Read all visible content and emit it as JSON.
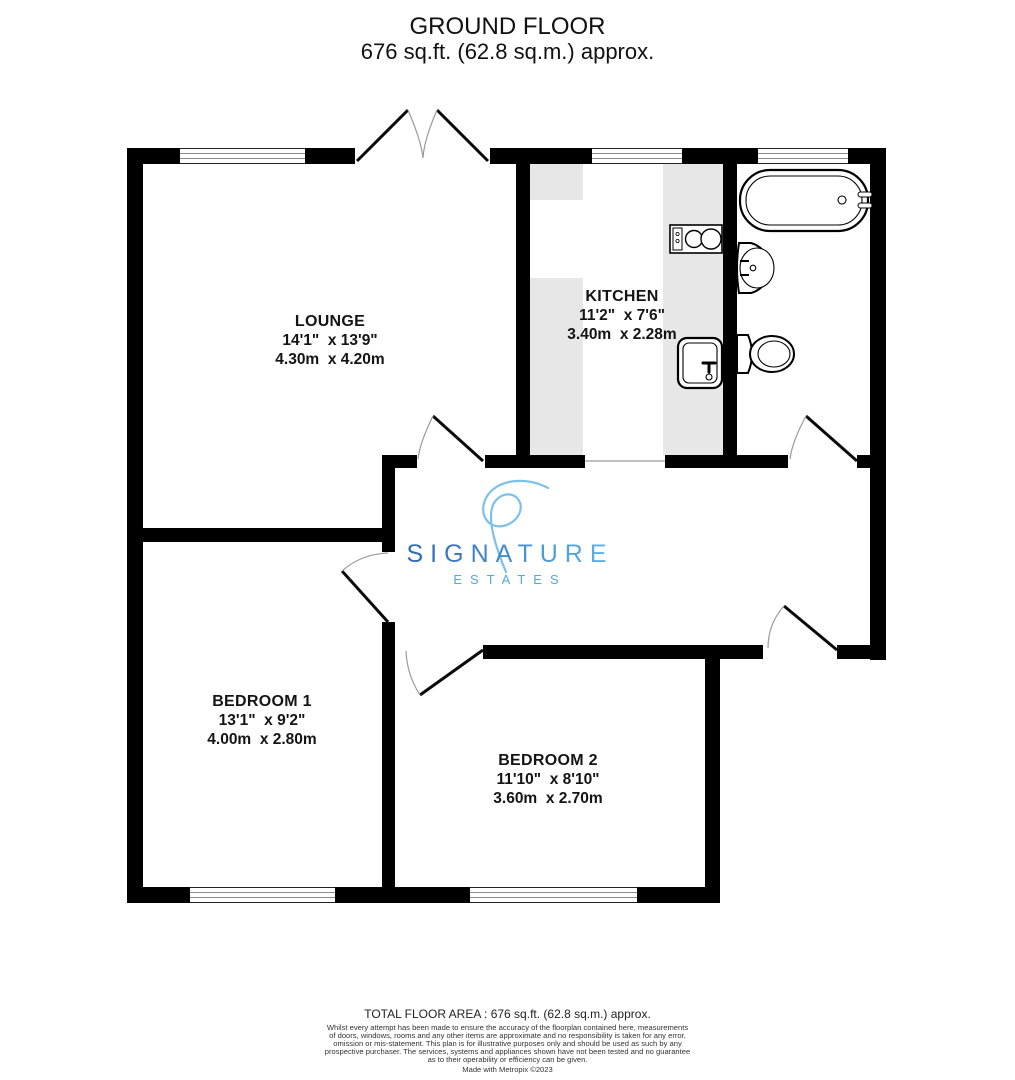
{
  "header": {
    "title": "GROUND FLOOR",
    "subtitle": "676 sq.ft. (62.8 sq.m.) approx."
  },
  "rooms": {
    "lounge": {
      "name": "LOUNGE",
      "imperial": "14'1\"  x 13'9\"",
      "metric": "4.30m  x 4.20m"
    },
    "kitchen": {
      "name": "KITCHEN",
      "imperial": "11'2\"  x 7'6\"",
      "metric": "3.40m  x 2.28m"
    },
    "bedroom1": {
      "name": "BEDROOM 1",
      "imperial": "13'1\"  x 9'2\"",
      "metric": "4.00m  x 2.80m"
    },
    "bedroom2": {
      "name": "BEDROOM 2",
      "imperial": "11'10\"  x 8'10\"",
      "metric": "3.60m  x 2.70m"
    }
  },
  "logo": {
    "brand": "SIGNATURE",
    "sub": "ESTATES"
  },
  "fixtures": [
    "bathtub-icon",
    "basin-icon",
    "toilet-icon",
    "hob-icon",
    "kitchen-sink-icon"
  ],
  "colors": {
    "wall": "#000000",
    "counter": "#e7e7e7",
    "door_arc": "#9a9a9a",
    "logo_blue_dark": "#2c67b0",
    "logo_blue_light": "#5fb6e8"
  },
  "footer": {
    "total": "TOTAL FLOOR AREA : 676 sq.ft. (62.8 sq.m.) approx.",
    "disclaimer_lines": [
      "Whilst every attempt has been made to ensure the accuracy of the floorplan contained here, measurements",
      "of doors, windows, rooms and any other items are approximate and no responsibility is taken for any error,",
      "omission or mis-statement. This plan is for illustrative purposes only and should be used as such by any",
      "prospective purchaser. The services, systems and appliances shown have not been tested and no guarantee",
      "as to their operability or efficiency can be given."
    ],
    "credit": "Made with Metropix ©2023"
  }
}
